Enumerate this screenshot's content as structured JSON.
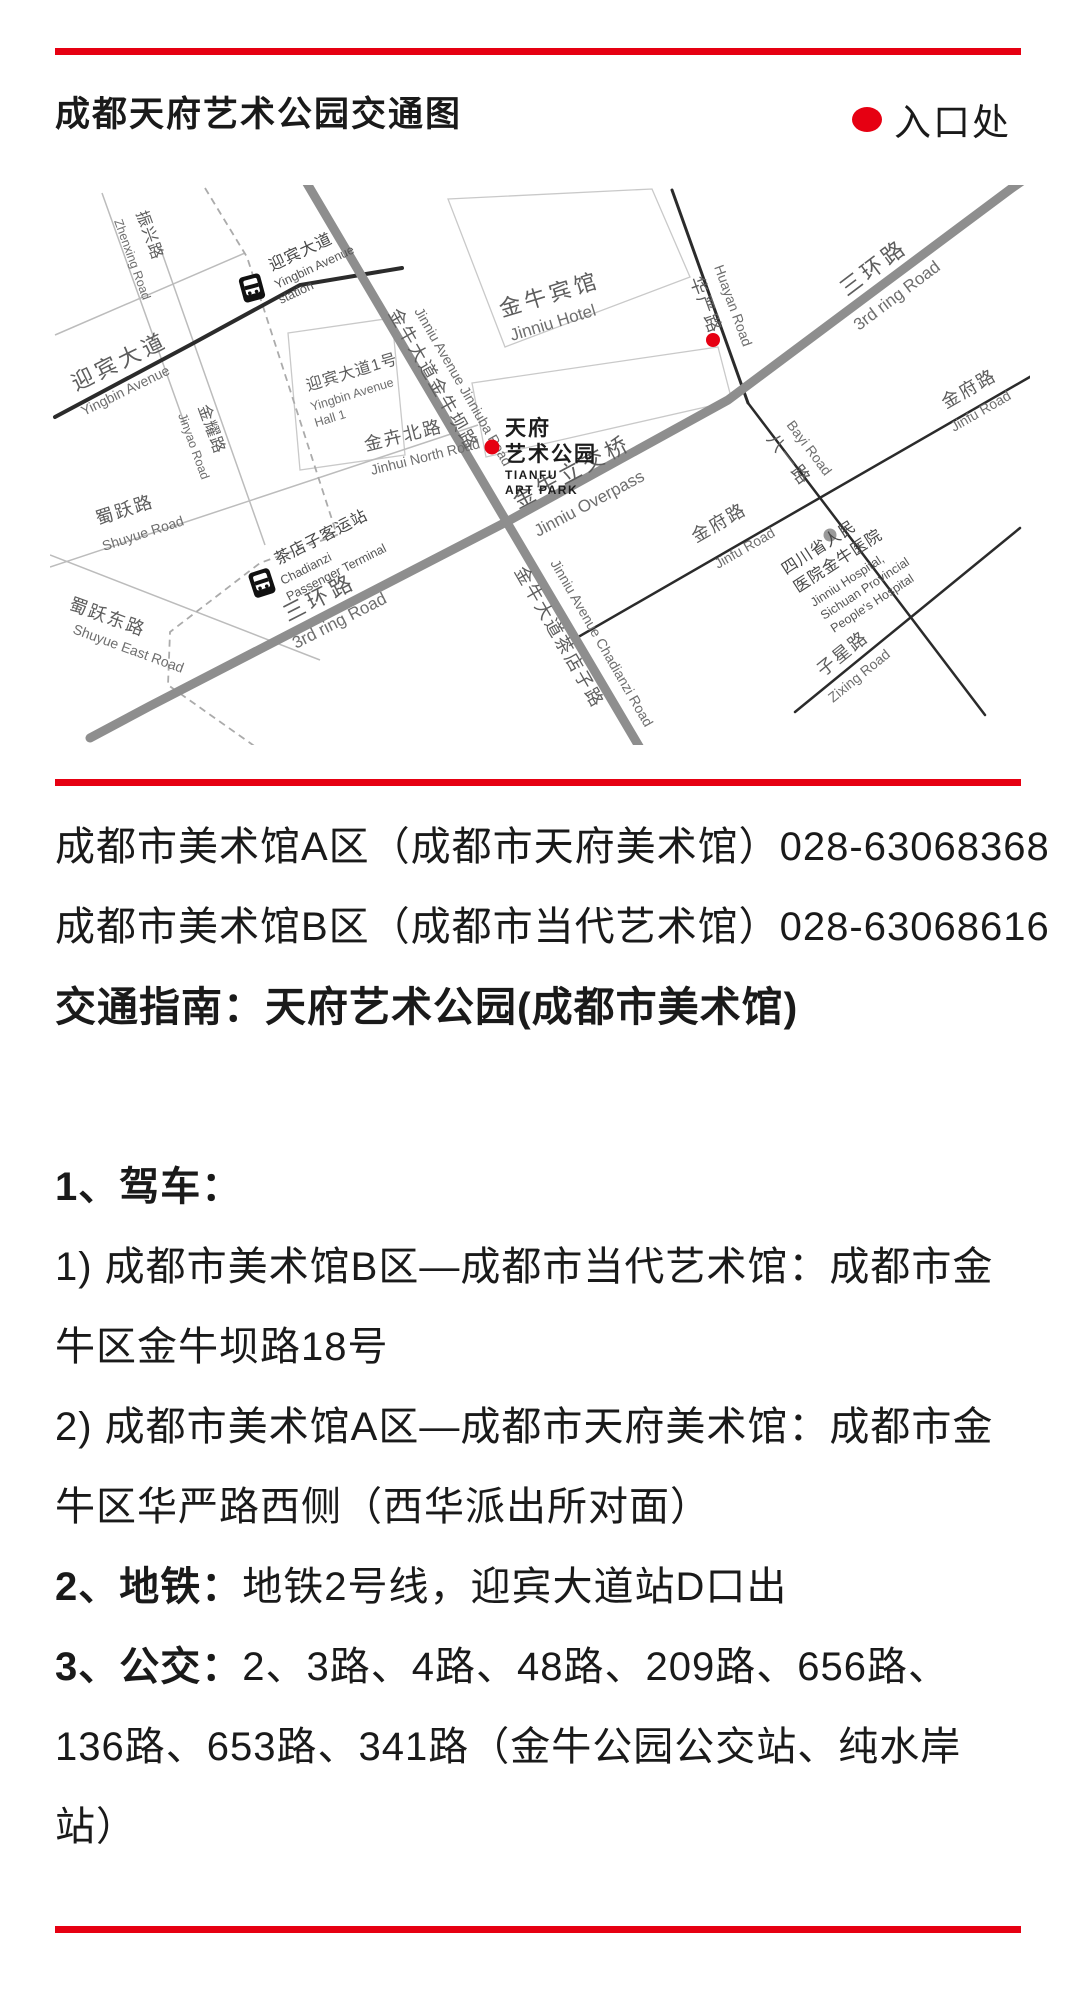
{
  "colors": {
    "accent_red": "#e60012",
    "road_major": "#8e8e8e",
    "road_dark": "#2b2b2b",
    "road_minor": "#bcbcbc",
    "marker_gray": "#9a9a9a"
  },
  "header": {
    "title": "成都天府艺术公园交通图",
    "legend_label": "入口处"
  },
  "map": {
    "labels": {
      "sanhuan_cn": "三环路",
      "sanhuan_en": "3rd ring Road",
      "overpass_cn": "金牛立交桥",
      "overpass_en": "Jinniu Overpass",
      "yingbin_cn": "迎宾大道",
      "yingbin_en": "Yingbin Avenue",
      "jinniu_ave_jinniuba_cn": "金牛大道金牛坝路",
      "jinniu_ave_jinniuba_en": "Jinniu Avenue Jinniuba Road",
      "jinniu_ave_chadianzi_cn": "金牛大道茶店子路",
      "jinniu_ave_chadianzi_en": "Jinniu Avenue Chadianzi Road",
      "huayan_cn": "华严路",
      "huayan_en": "Huayan Road",
      "bayi_cn": "八一路",
      "bayi_en": "Bayi Road",
      "jinfu_cn": "金府路",
      "jinfu_en": "Jinfu Road",
      "zixing_cn": "子星路",
      "zixing_en": "Zixing Road",
      "jinhui_cn": "金卉北路",
      "jinhui_en": "Jinhui North Road",
      "shuyue_cn": "蜀跃路",
      "shuyue_en": "Shuyue Road",
      "shuyue_east_cn": "蜀跃东路",
      "shuyue_east_en": "Shuyue East Road",
      "zhenxing_cn": "振兴路",
      "zhenxing_en": "Zhenxing Road",
      "jinyao_cn": "金耀路",
      "jinyao_en": "Jinyao Road"
    },
    "places": {
      "hotel_cn": "金牛宾馆",
      "hotel_en": "Jinniu Hotel",
      "park_cn_1": "天府",
      "park_cn_2": "艺术公园",
      "park_en_1": "TIANFU",
      "park_en_2": "ART PARK",
      "hall_cn": "迎宾大道1号",
      "hall_en_1": "Yingbin Avenue",
      "hall_en_2": "Hall 1",
      "metro_cn": "迎宾大道",
      "metro_en_1": "Yingbin Avenue",
      "metro_en_2": "station",
      "terminal_cn": "茶店子客运站",
      "terminal_en_1": "Chadianzi",
      "terminal_en_2": "Passenger Terminal",
      "hospital_cn_1": "四川省人民",
      "hospital_cn_2": "医院金牛医院",
      "hospital_en_1": "Jinniu Hospital,",
      "hospital_en_2": "Sichuan Provincial",
      "hospital_en_3": "People's Hospital"
    }
  },
  "contact": {
    "line_a": "成都市美术馆A区（成都市天府美术馆）028-63068368",
    "line_b": "成都市美术馆B区（成都市当代艺术馆）028-63068616"
  },
  "guide": {
    "heading": "交通指南：天府艺术公园(成都市美术馆)",
    "drive_label": "1、驾车：",
    "drive_1a": "1) 成都市美术馆B区—成都市当代艺术馆：成都市金",
    "drive_1b": "牛区金牛坝路18号",
    "drive_2a": "2) 成都市美术馆A区—成都市天府美术馆：成都市金",
    "drive_2b": "牛区华严路西侧（西华派出所对面）",
    "metro_label": "2、地铁：",
    "metro_text": "地铁2号线，迎宾大道站D口出",
    "bus_label": "3、公交：",
    "bus_text_1": "2、3路、4路、48路、209路、656路、",
    "bus_text_2": "136路、653路、341路（金牛公园公交站、纯水岸",
    "bus_text_3": "站）"
  }
}
